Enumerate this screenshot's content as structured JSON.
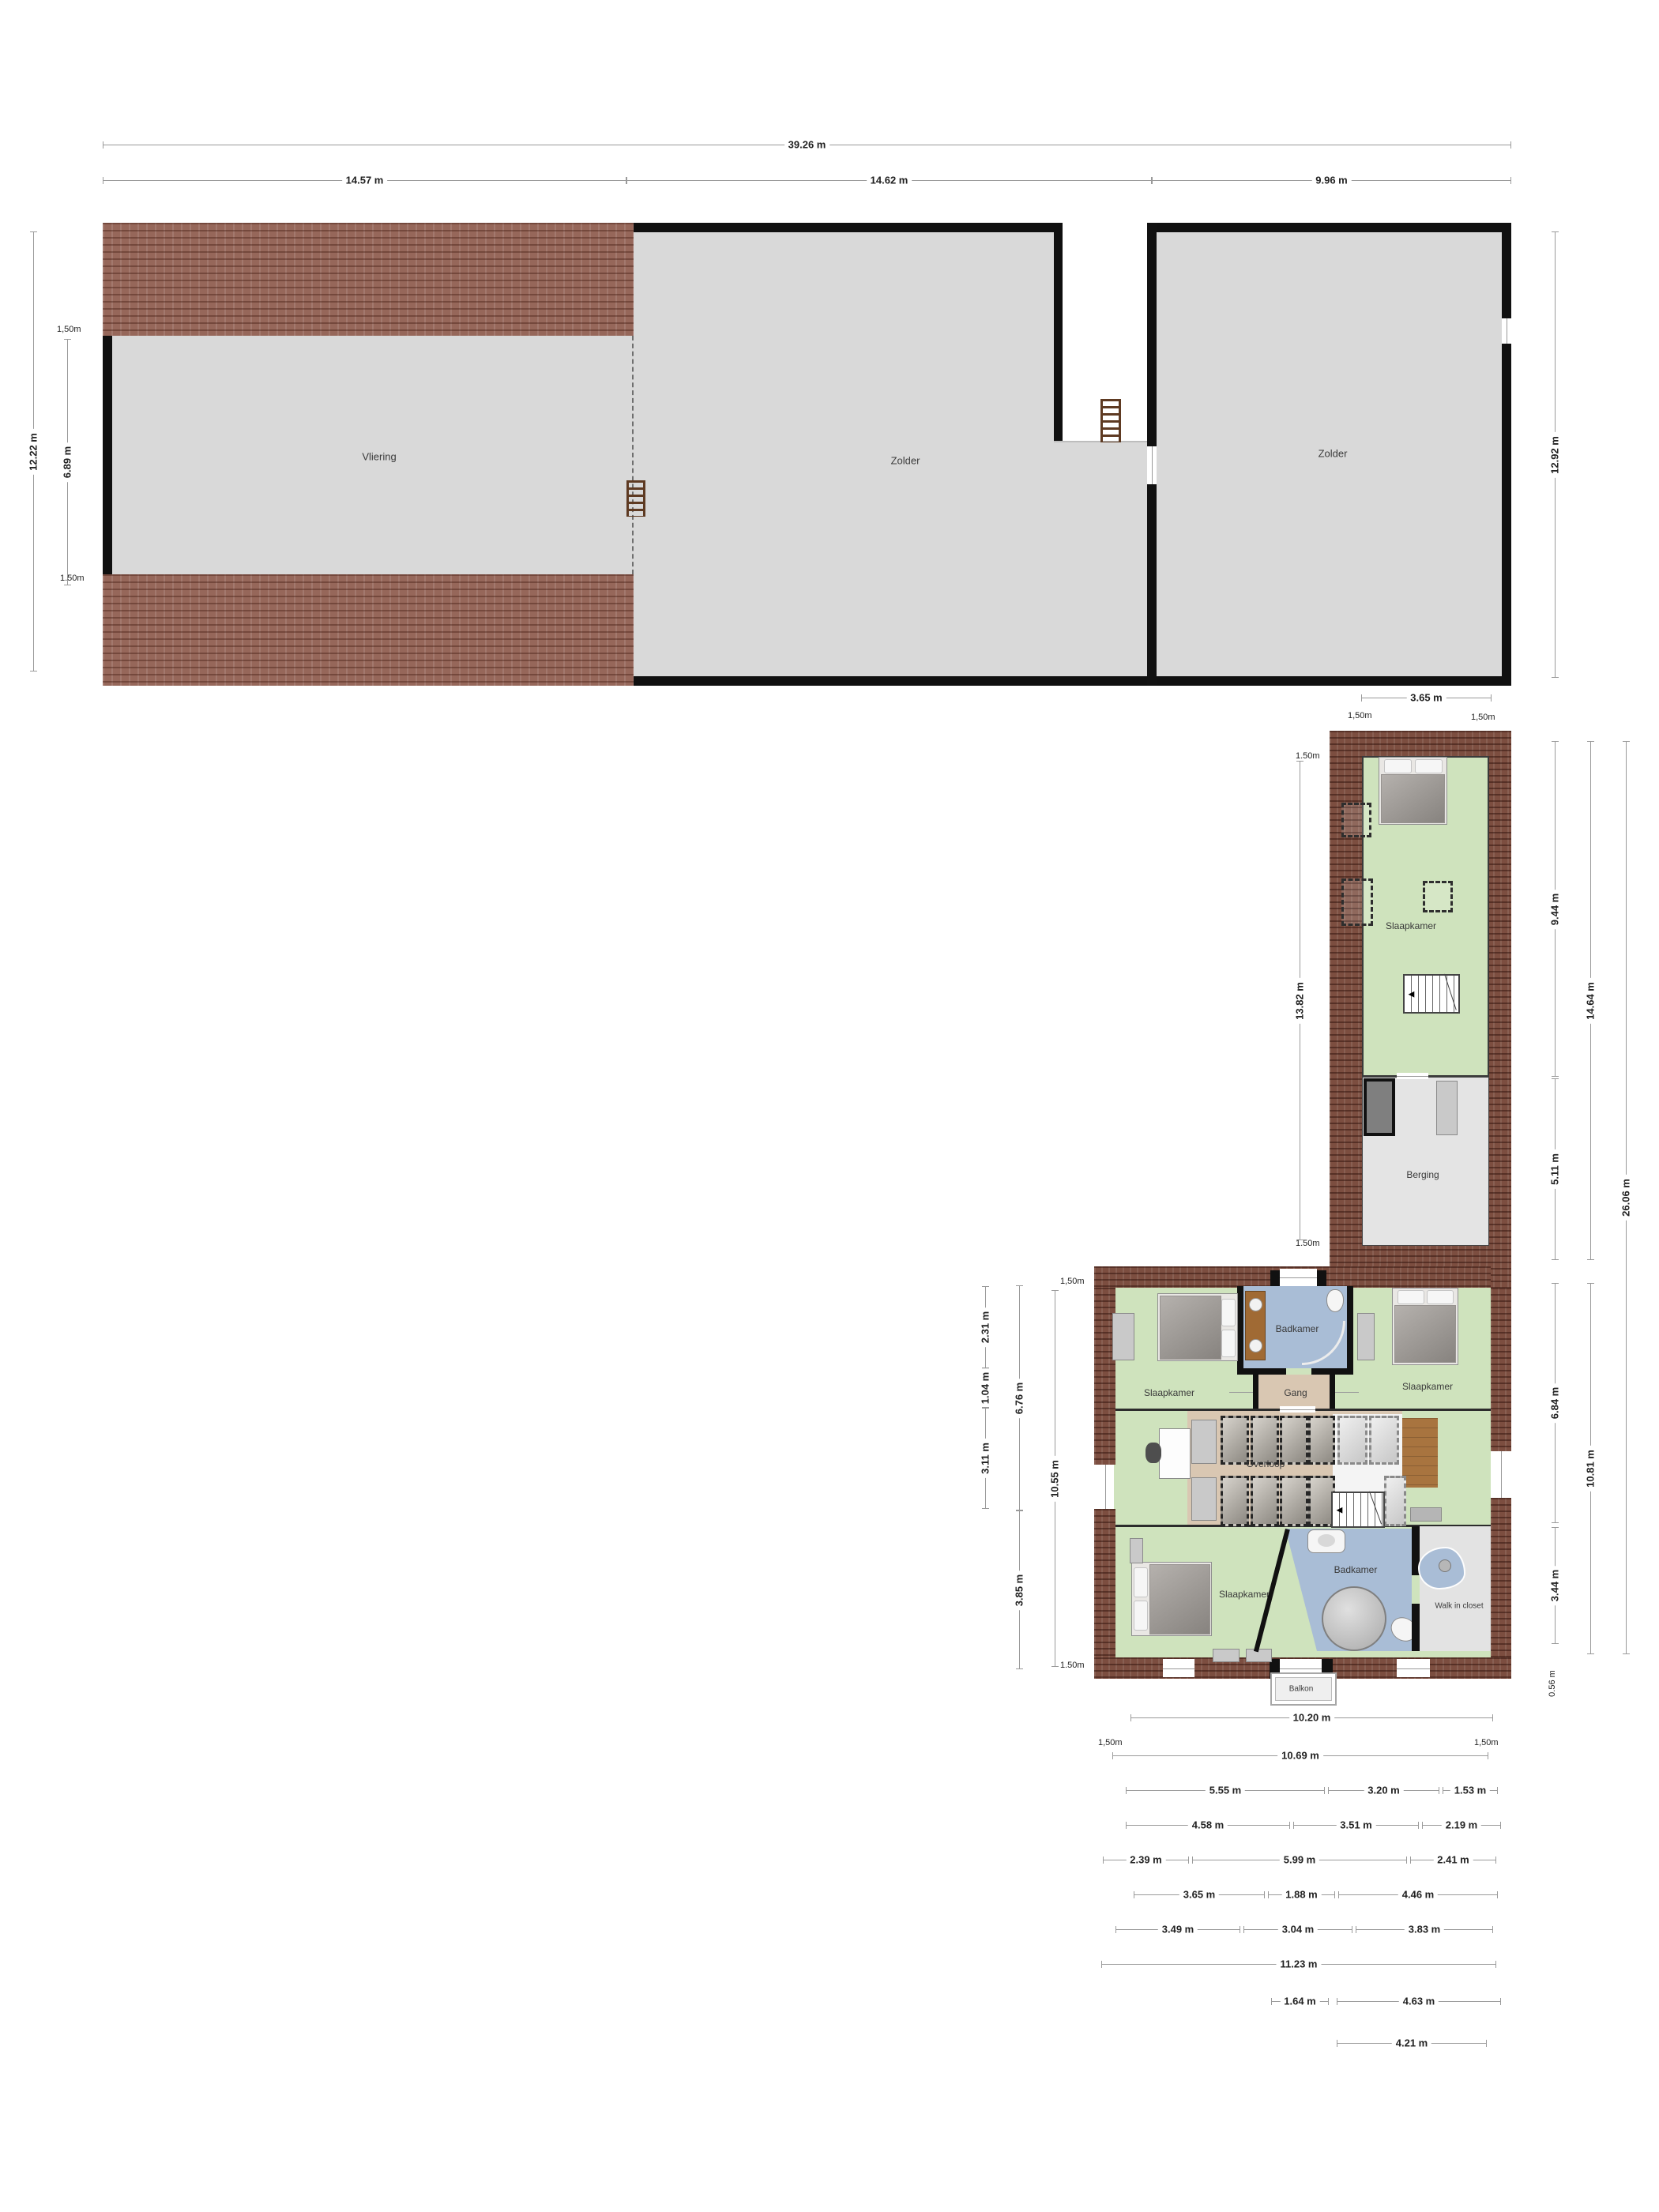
{
  "rooms": {
    "vliering": "Vliering",
    "zolder_mid": "Zolder",
    "zolder_right": "Zolder",
    "wing_slaapkamer": "Slaapkamer",
    "berging": "Berging",
    "slaapkamer_tl": "Slaapkamer",
    "badkamer_top": "Badkamer",
    "slaapkamer_tr": "Slaapkamer",
    "gang": "Gang",
    "overloop": "Overloop",
    "slaapkamer_bl": "Slaapkamer",
    "badkamer_bottom": "Badkamer",
    "walk_in_closet": "Walk in closet",
    "balkon": "Balkon"
  },
  "dimensions": {
    "attic": {
      "total": "39.26 m",
      "sections": [
        "14.57 m",
        "14.62 m",
        "9.96 m"
      ],
      "left_outer": "12.22 m",
      "left_inner": "6.89 m",
      "knee_top": "1,50m",
      "knee_bottom": "1.50m",
      "right": "12.92 m"
    },
    "wing": {
      "width": "3.65 m",
      "eave_left": "1,50m",
      "eave_right": "1,50m",
      "knee_top": "1.50m",
      "length": "13.82 m",
      "knee_bottom": "1.50m",
      "col1_top": "9.44 m",
      "col1_bottom": "5.11 m",
      "col2": "14.64 m",
      "col3": "26.06 m"
    },
    "house": {
      "left_col1": [
        "2.31 m",
        "1.04 m",
        "3.11 m"
      ],
      "left_col2": [
        "6.76 m",
        "3.85 m"
      ],
      "left_col3": "10.55 m",
      "knee_top": "1,50m",
      "knee_bottom": "1.50m",
      "right_col1": [
        "6.84 m",
        "3.44 m"
      ],
      "right_col2": "10.81 m",
      "right_overhang": "0.56 m",
      "total": "10.20 m",
      "eaves": [
        "1,50m",
        "1,50m"
      ],
      "inner": "10.69 m",
      "rows": [
        [
          "5.55 m",
          "3.20 m",
          "1.53 m"
        ],
        [
          "4.58 m",
          "3.51 m",
          "2.19 m"
        ],
        [
          "2.39 m",
          "5.99 m",
          "2.41 m"
        ],
        [
          "3.65 m",
          "1.88 m",
          "4.46 m"
        ],
        [
          "3.49 m",
          "3.04 m",
          "3.83 m"
        ]
      ],
      "row_total": "11.23 m",
      "row_pair": [
        "1.64 m",
        "4.63 m"
      ],
      "row_last": "4.21 m"
    }
  },
  "colors": {
    "brick": "#96675a",
    "brick_dark": "#7c4e40",
    "room_green": "#cfe3bd",
    "room_gray": "#d9d9d9",
    "bathroom_blue": "#a9bdd6",
    "floor_tan": "#d9c7b2",
    "wood": "#a8743f"
  }
}
